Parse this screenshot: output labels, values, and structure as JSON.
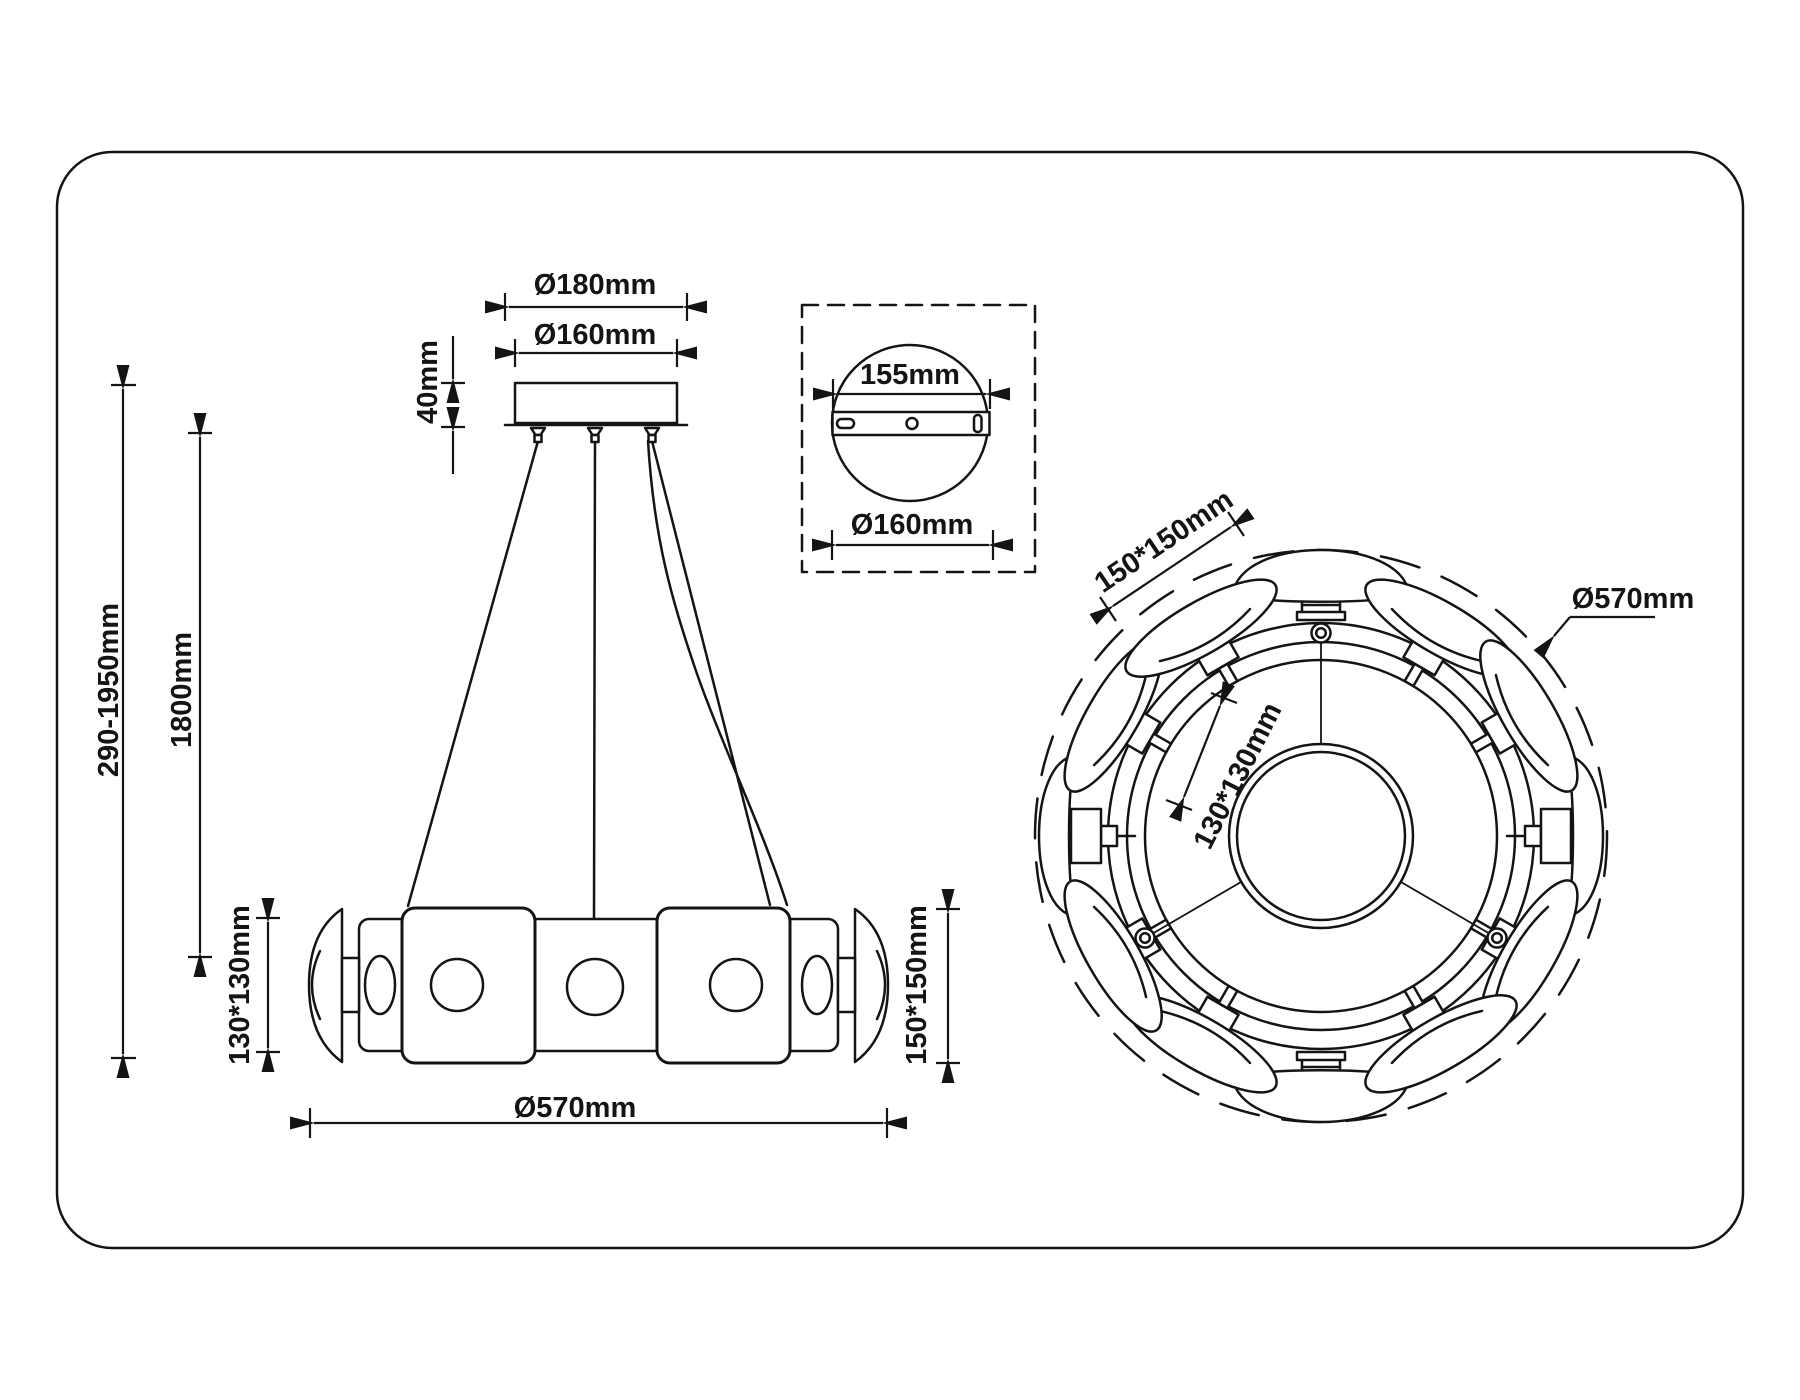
{
  "title": "Pendant chandelier dimension drawing",
  "colors": {
    "line": "#141414",
    "background": "#ffffff"
  },
  "front_view": {
    "canopy_outer_diameter": "Ø180mm",
    "canopy_diameter": "Ø160mm",
    "canopy_height": "40mm",
    "suspension_range": "290-1950mm",
    "wire_length": "1800mm",
    "shade_size_left": "130*130mm",
    "shade_size_right": "150*150mm",
    "fixture_diameter": "Ø570mm"
  },
  "mount_detail": {
    "bracket_length": "155mm",
    "plate_diameter": "Ø160mm"
  },
  "top_view": {
    "shade_size": "150*150mm",
    "inner_size": "130*130mm",
    "fixture_diameter": "Ø570mm"
  }
}
